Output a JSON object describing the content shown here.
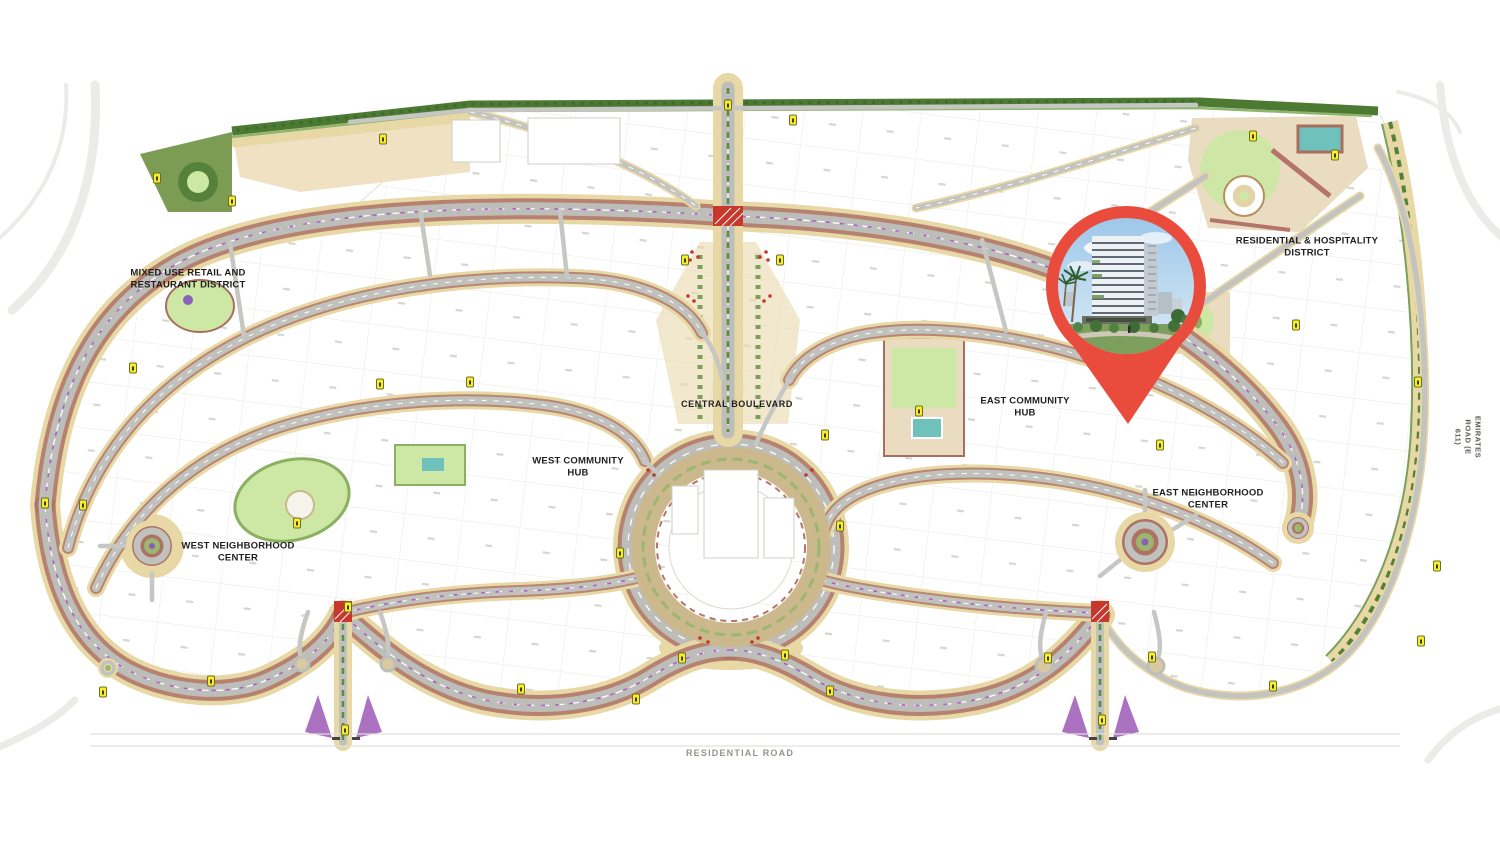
{
  "map": {
    "title": "community masterplan",
    "labels": [
      {
        "id": "mixed-use-district",
        "lines": [
          "MIXED USE RETAIL AND",
          "RESTAURANT DISTRICT"
        ],
        "x": 188,
        "y": 280
      },
      {
        "id": "central-boulevard",
        "lines": [
          "CENTRAL BOULEVARD"
        ],
        "x": 737,
        "y": 405,
        "size": 9,
        "ls": 0.6
      },
      {
        "id": "west-community-hub",
        "lines": [
          "WEST COMMUNITY",
          "HUB"
        ],
        "x": 578,
        "y": 468
      },
      {
        "id": "east-community-hub",
        "lines": [
          "EAST COMMUNITY",
          "HUB"
        ],
        "x": 1025,
        "y": 408
      },
      {
        "id": "residential-hospitality-district",
        "lines": [
          "RESIDENTIAL & HOSPITALITY",
          "DISTRICT"
        ],
        "x": 1307,
        "y": 248
      },
      {
        "id": "west-neighborhood-center",
        "lines": [
          "WEST NEIGHBORHOOD",
          "CENTER"
        ],
        "x": 238,
        "y": 553
      },
      {
        "id": "east-neighborhood-center",
        "lines": [
          "EAST NEIGHBORHOOD",
          "CENTER"
        ],
        "x": 1208,
        "y": 500
      },
      {
        "id": "residential-road",
        "lines": [
          "RESIDENTIAL ROAD"
        ],
        "x": 740,
        "y": 754,
        "size": 9,
        "color": "#94948d",
        "weight": 600,
        "ls": 1.2
      },
      {
        "id": "emirates-road",
        "lines": [
          "EMIRATES ROAD (E 611)"
        ],
        "x": 1468,
        "y": 437,
        "size": 7.5,
        "color": "#5a5a55",
        "weight": 600,
        "rot": 90,
        "ls": 0.5
      }
    ],
    "plot_markers": [
      [
        157,
        178
      ],
      [
        232,
        201
      ],
      [
        383,
        139
      ],
      [
        728,
        105
      ],
      [
        793,
        120
      ],
      [
        685,
        260
      ],
      [
        780,
        260
      ],
      [
        1253,
        136
      ],
      [
        1335,
        155
      ],
      [
        1418,
        382
      ],
      [
        1437,
        566
      ],
      [
        1421,
        641
      ],
      [
        133,
        368
      ],
      [
        380,
        384
      ],
      [
        470,
        382
      ],
      [
        45,
        503
      ],
      [
        83,
        505
      ],
      [
        103,
        692
      ],
      [
        211,
        681
      ],
      [
        297,
        523
      ],
      [
        348,
        607
      ],
      [
        345,
        730
      ],
      [
        521,
        689
      ],
      [
        636,
        699
      ],
      [
        825,
        435
      ],
      [
        620,
        553
      ],
      [
        840,
        526
      ],
      [
        682,
        658
      ],
      [
        785,
        655
      ],
      [
        830,
        691
      ],
      [
        1048,
        658
      ],
      [
        1152,
        657
      ],
      [
        1102,
        720
      ],
      [
        919,
        411
      ],
      [
        1160,
        445
      ],
      [
        1273,
        686
      ],
      [
        1296,
        325
      ]
    ],
    "pin": {
      "x": 1126,
      "y": 286,
      "tip_y": 424,
      "color": "#e94b3d",
      "photo": "modern-residential-building-with-landscape"
    },
    "colors": {
      "pin_red": "#e94b3d",
      "marker_yellow": "#f6ee2e",
      "road_gray": "#bdbdba",
      "road_edge_brown": "#ad7264",
      "buffer_tan": "#e7d8a6",
      "park_light_green": "#cde7a4",
      "park_dark_green": "#4d7a33",
      "pool_teal": "#6fc2bc",
      "accent_purple": "#a551c5",
      "intersection_red": "#c8372c"
    }
  }
}
